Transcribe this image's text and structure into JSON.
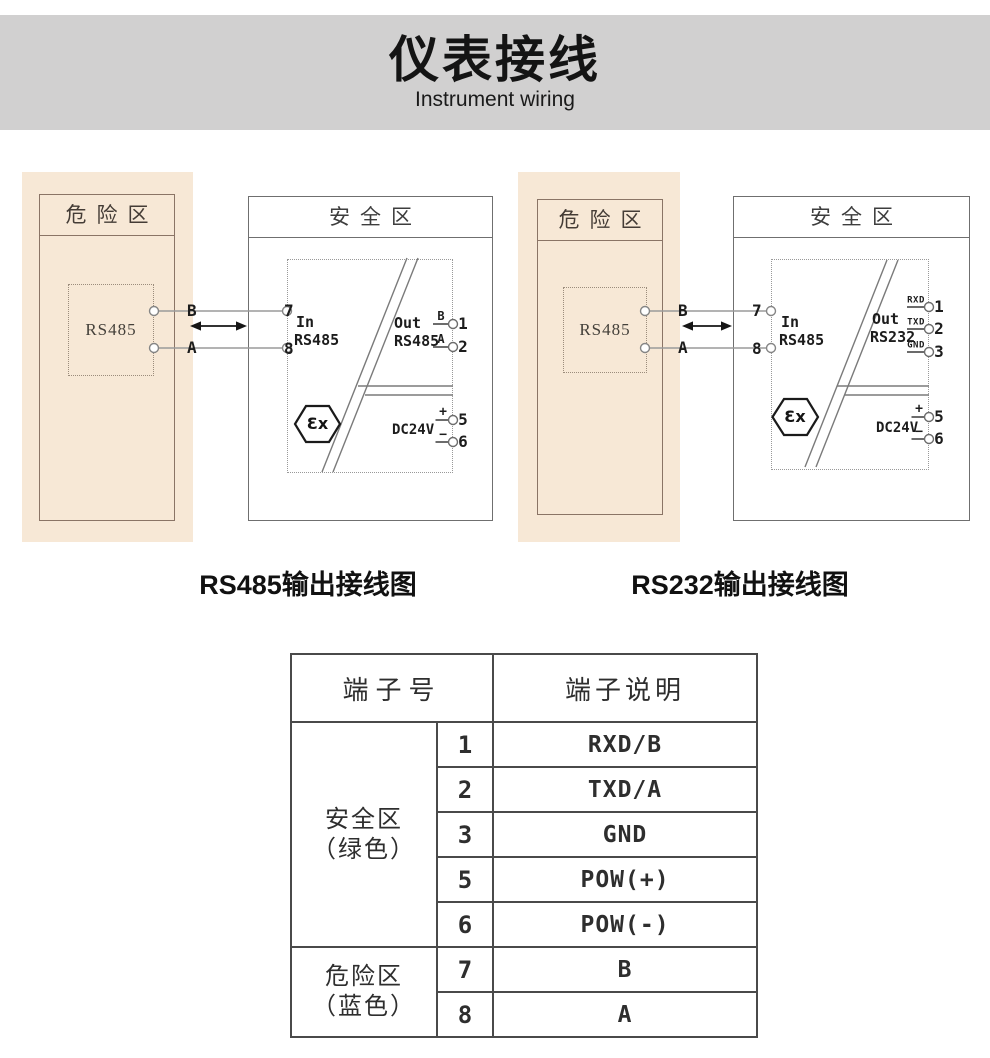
{
  "header": {
    "title_cn": "仪表接线",
    "title_en": "Instrument wiring"
  },
  "colors": {
    "banner_bg": "#d1d0d0",
    "hazard_bg": "#f7e8d6",
    "hazard_border": "#8a7466",
    "safe_border": "#6f6f6f",
    "wire": "#9a9a9a",
    "barrier_line": "#7a7a7a",
    "table_border": "#4a4a4a",
    "text": "#1c1c1c"
  },
  "diagrams": [
    {
      "hazard_zone": "危险区",
      "safe_zone": "安全区",
      "device": "RS485",
      "wire_top": "B",
      "wire_bottom": "A",
      "in_top_no": "7",
      "in_bottom_no": "8",
      "in_line1": "In",
      "in_line2": "RS485",
      "out_line1": "Out",
      "out_line2": "RS485",
      "out1_sig": "B",
      "out1_no": "1",
      "out2_sig": "A",
      "out2_no": "2",
      "ex": "Ɛx",
      "power": "DC24V",
      "pow_plus": "+",
      "pow_plus_no": "5",
      "pow_minus": "−",
      "pow_minus_no": "6",
      "caption": "RS485输出接线图"
    },
    {
      "hazard_zone": "危险区",
      "safe_zone": "安全区",
      "device": "RS485",
      "wire_top": "B",
      "wire_bottom": "A",
      "in_top_no": "7",
      "in_bottom_no": "8",
      "in_line1": "In",
      "in_line2": "RS485",
      "out_line1": "Out",
      "out_line2": "RS232",
      "out1_sig": "RXD",
      "out1_no": "1",
      "out2_sig": "TXD",
      "out2_no": "2",
      "out3_sig": "GND",
      "out3_no": "3",
      "ex": "Ɛx",
      "power": "DC24V",
      "pow_plus": "+",
      "pow_plus_no": "5",
      "pow_minus": "−",
      "pow_minus_no": "6",
      "caption": "RS232输出接线图"
    }
  ],
  "table": {
    "header_no": "端子号",
    "header_desc": "端子说明",
    "groups": [
      {
        "zone": "安全区",
        "note": "（绿色）",
        "rows": [
          {
            "no": "1",
            "desc": "RXD/B"
          },
          {
            "no": "2",
            "desc": "TXD/A"
          },
          {
            "no": "3",
            "desc": "GND"
          },
          {
            "no": "5",
            "desc": "POW(+)"
          },
          {
            "no": "6",
            "desc": "POW(-)"
          }
        ]
      },
      {
        "zone": "危险区",
        "note": "（蓝色）",
        "rows": [
          {
            "no": "7",
            "desc": "B"
          },
          {
            "no": "8",
            "desc": "A"
          }
        ]
      }
    ]
  }
}
